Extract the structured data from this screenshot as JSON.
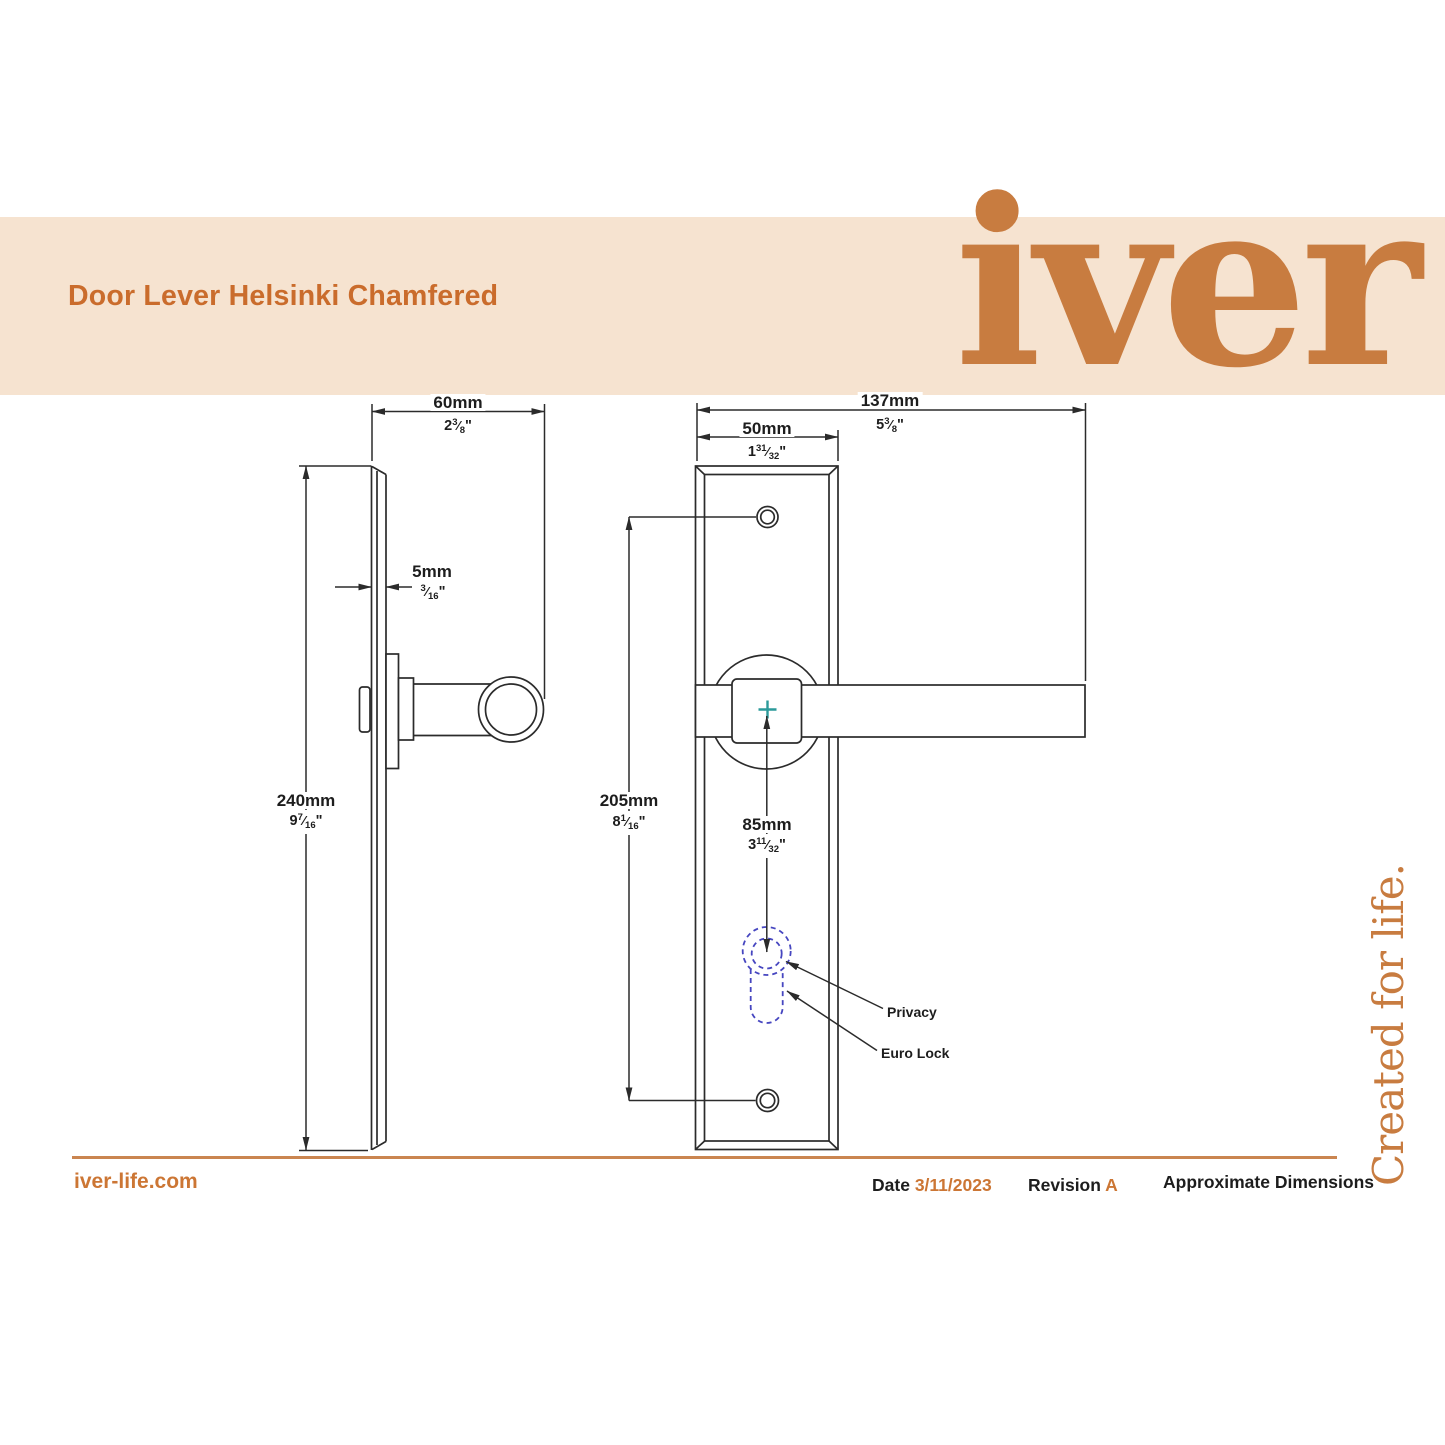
{
  "header": {
    "title": "Door Lever Helsinki Chamfered",
    "logo": "iver"
  },
  "tagline": "Created for life.",
  "drawing": {
    "dimensions": {
      "projection": {
        "mm": "60mm",
        "in_whole": "2",
        "in_num": "3",
        "in_den": "8"
      },
      "thickness": {
        "mm": "5mm",
        "in_whole": "",
        "in_num": "3",
        "in_den": "16"
      },
      "plate_height": {
        "mm": "240mm",
        "in_whole": "9",
        "in_num": "7",
        "in_den": "16"
      },
      "overall_width": {
        "mm": "137mm",
        "in_whole": "5",
        "in_num": "3",
        "in_den": "8"
      },
      "plate_width": {
        "mm": "50mm",
        "in_whole": "1",
        "in_num": "31",
        "in_den": "32"
      },
      "screw_centres": {
        "mm": "205mm",
        "in_whole": "8",
        "in_num": "1",
        "in_den": "16"
      },
      "lock_centre": {
        "mm": "85mm",
        "in_whole": "3",
        "in_num": "11",
        "in_den": "32"
      }
    },
    "callouts": {
      "privacy": "Privacy",
      "euro_lock": "Euro Lock"
    }
  },
  "footer": {
    "website": "iver-life.com",
    "date_label": "Date",
    "date_value": "3/11/2023",
    "revision_label": "Revision",
    "revision_value": "A",
    "note": "Approximate Dimensions"
  },
  "ui": {
    "fraction_slash": "⁄",
    "inch_mark": "\""
  },
  "colors": {
    "banner_bg": "#f6e3d0",
    "title_orange": "#ca6c2c",
    "logo_orange": "#c87c40",
    "line": "#2b2b2b",
    "keyhole_blue": "#4646c0",
    "centre_cross_teal": "#2b9a9a",
    "rule_orange": "#ca8550",
    "footer_orange": "#cc7634"
  }
}
